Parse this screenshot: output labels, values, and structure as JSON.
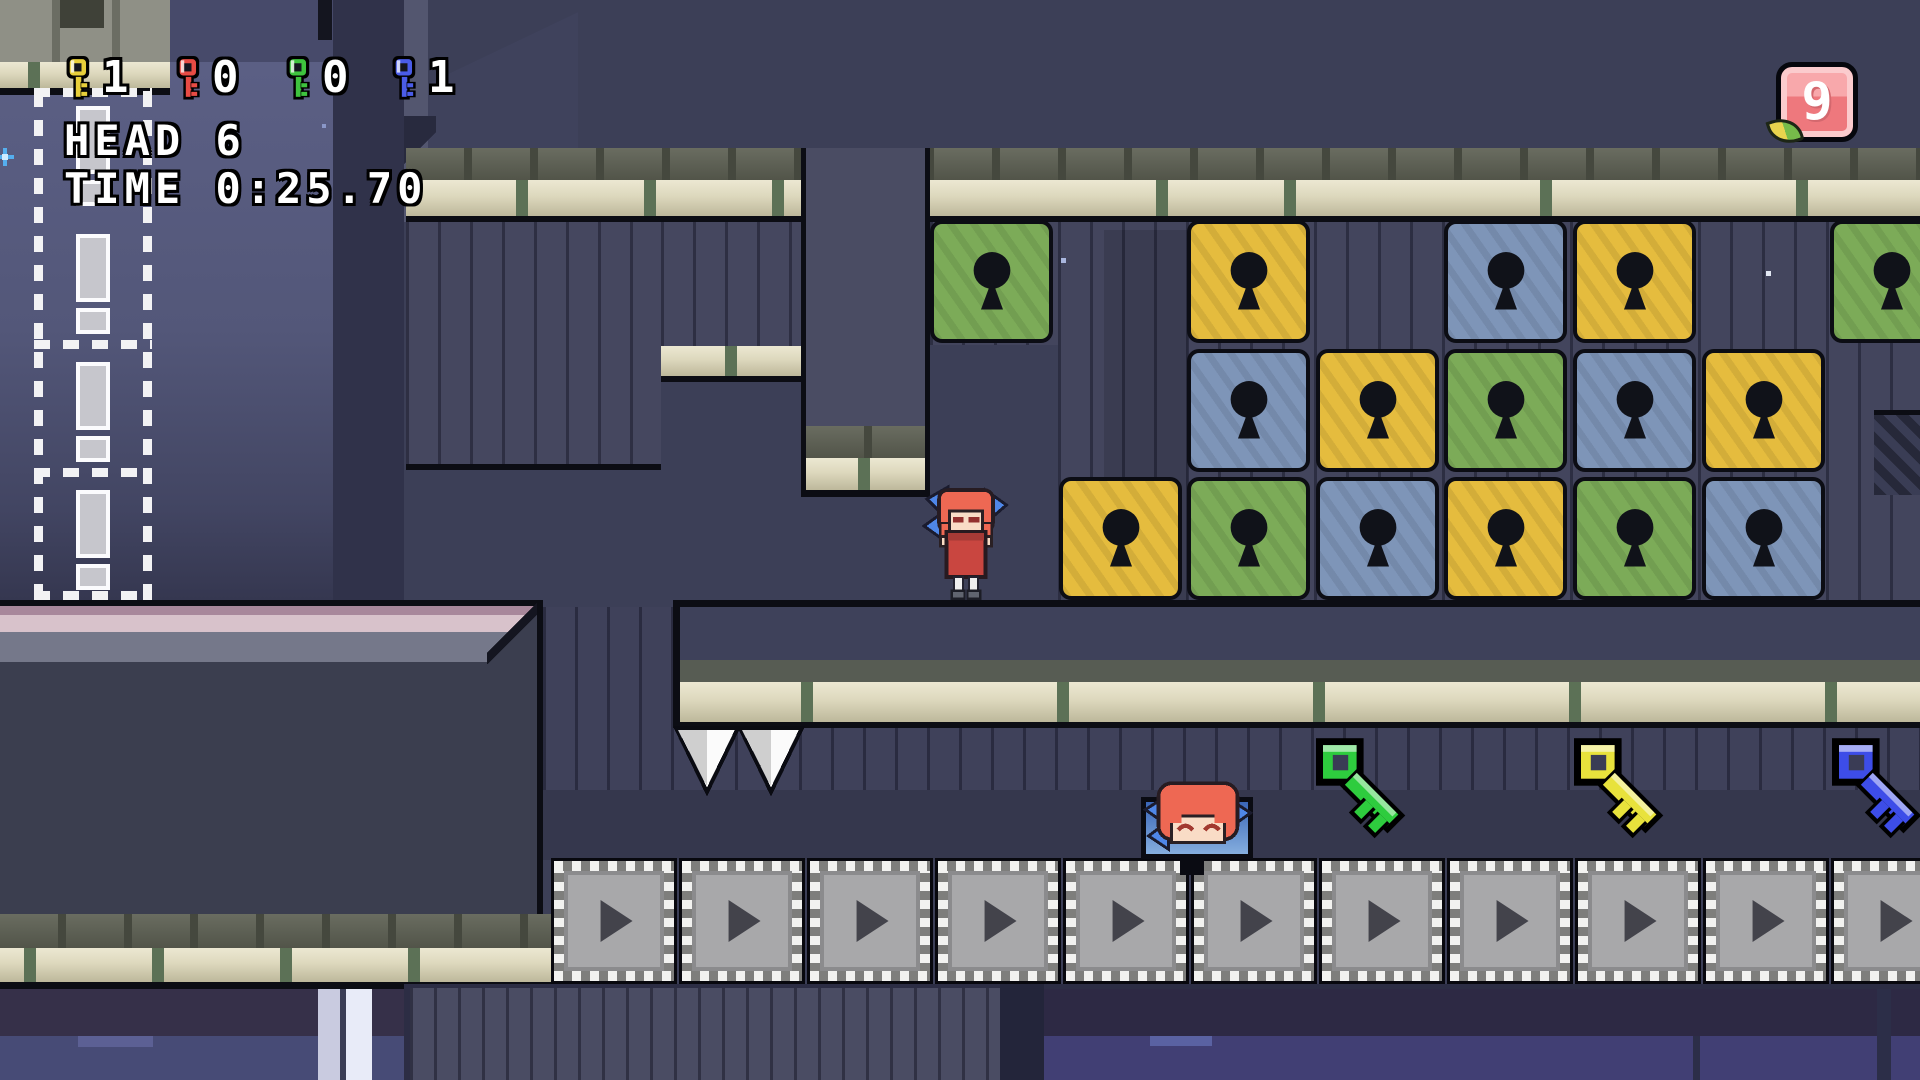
{
  "hud": {
    "key_counters": [
      {
        "name": "yellow-key-count",
        "color": "#e8cf3a",
        "count": "1"
      },
      {
        "name": "red-key-count",
        "color": "#e84b44",
        "count": "0"
      },
      {
        "name": "green-key-count",
        "color": "#3ec43e",
        "count": "0"
      },
      {
        "name": "blue-key-count",
        "color": "#4a5ce8",
        "count": "1"
      }
    ],
    "head_label": "HEAD",
    "head_value": "6",
    "time_label": "TIME",
    "time_value": "0:25.70"
  },
  "badge": {
    "value": "9"
  },
  "lock_grid": {
    "origin_x": 930,
    "origin_y": 220,
    "cell_pitch": 128.6,
    "colors": {
      "green": "#7cab58",
      "yellow": "#e5bc3e",
      "blue": "#7e95b8"
    },
    "cells": [
      {
        "row": 0,
        "col": 0,
        "color": "green"
      },
      {
        "row": 0,
        "col": 2,
        "color": "yellow"
      },
      {
        "row": 0,
        "col": 4,
        "color": "blue"
      },
      {
        "row": 0,
        "col": 5,
        "color": "yellow"
      },
      {
        "row": 0,
        "col": 7,
        "color": "green"
      },
      {
        "row": 1,
        "col": 2,
        "color": "blue"
      },
      {
        "row": 1,
        "col": 3,
        "color": "yellow"
      },
      {
        "row": 1,
        "col": 4,
        "color": "green"
      },
      {
        "row": 1,
        "col": 5,
        "color": "blue"
      },
      {
        "row": 1,
        "col": 6,
        "color": "yellow"
      },
      {
        "row": 2,
        "col": 1,
        "color": "yellow"
      },
      {
        "row": 2,
        "col": 2,
        "color": "green"
      },
      {
        "row": 2,
        "col": 3,
        "color": "blue"
      },
      {
        "row": 2,
        "col": 4,
        "color": "yellow"
      },
      {
        "row": 2,
        "col": 5,
        "color": "green"
      },
      {
        "row": 2,
        "col": 6,
        "color": "blue"
      }
    ]
  },
  "field_keys": [
    {
      "name": "green-key",
      "color": "#2ecc3e",
      "x": 1316,
      "y": 738
    },
    {
      "name": "yellow-key",
      "color": "#e8e23c",
      "x": 1574,
      "y": 738
    },
    {
      "name": "blue-key",
      "color": "#3d4de8",
      "x": 1832,
      "y": 738
    }
  ],
  "conveyors": {
    "count": 11,
    "x": 551,
    "y": 858,
    "pitch": 128,
    "direction": "right"
  },
  "spikes": {
    "x": 674,
    "y": 724,
    "count": 2
  },
  "exclamation_column": {
    "x": 34,
    "y": 88,
    "width": 118,
    "height": 512,
    "tiles": 4
  },
  "characters": {
    "sekibanki": {
      "x": 921,
      "y": 484
    },
    "floating_head": {
      "x": 1140,
      "y": 779
    }
  },
  "stars": [
    {
      "x": 322,
      "y": 124,
      "size": 4,
      "color": "#8a97c8"
    },
    {
      "x": 1061,
      "y": 258,
      "size": 5,
      "color": "#a9b6de"
    },
    {
      "x": 1766,
      "y": 271,
      "size": 5,
      "color": "#e2e7f2"
    }
  ],
  "palette": {
    "sky_dark": "#3c3f57",
    "sky_light": "#575b80",
    "panel": "#45475f",
    "platform_body": "#3b3e4f",
    "tan_top": "#ddd8bd",
    "conveyor_face": "#a8a8aa"
  }
}
